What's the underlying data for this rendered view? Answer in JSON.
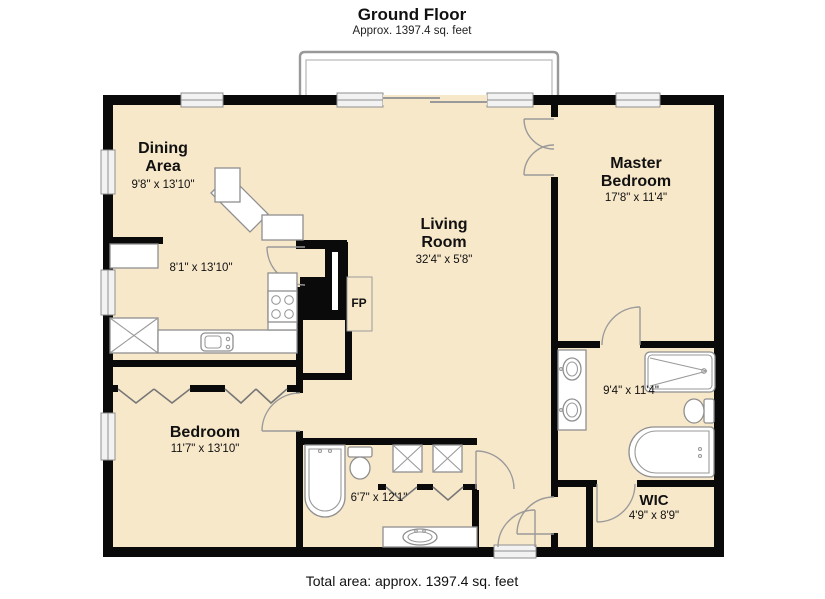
{
  "header": {
    "title": "Ground Floor",
    "subtitle": "Approx. 1397.4 sq. feet"
  },
  "footer": {
    "caption": "Total area: approx. 1397.4 sq. feet"
  },
  "colors": {
    "floor": "#f8e8ca",
    "wall": "#0a0a0a",
    "fixture_outline": "#8f8f8f",
    "text": "#111111"
  },
  "rooms": {
    "dining": {
      "name_line1": "Dining",
      "name_line2": "Area",
      "dims": "9'8\" x 13'10\""
    },
    "kitchen": {
      "dims": "8'1\" x 13'10\""
    },
    "living": {
      "name_line1": "Living",
      "name_line2": "Room",
      "dims": "32'4\" x 5'8\""
    },
    "master_bedroom": {
      "name_line1": "Master",
      "name_line2": "Bedroom",
      "dims": "17'8\" x 11'4\""
    },
    "bedroom": {
      "name": "Bedroom",
      "dims": "11'7\" x 13'10\""
    },
    "bathroom": {
      "dims": "6'7\" x 12'1\""
    },
    "master_bathroom": {
      "dims": "9'4\" x 11'4\""
    },
    "wic": {
      "name": "WIC",
      "dims": "4'9\" x 8'9\""
    },
    "fireplace": {
      "label": "FP"
    }
  }
}
